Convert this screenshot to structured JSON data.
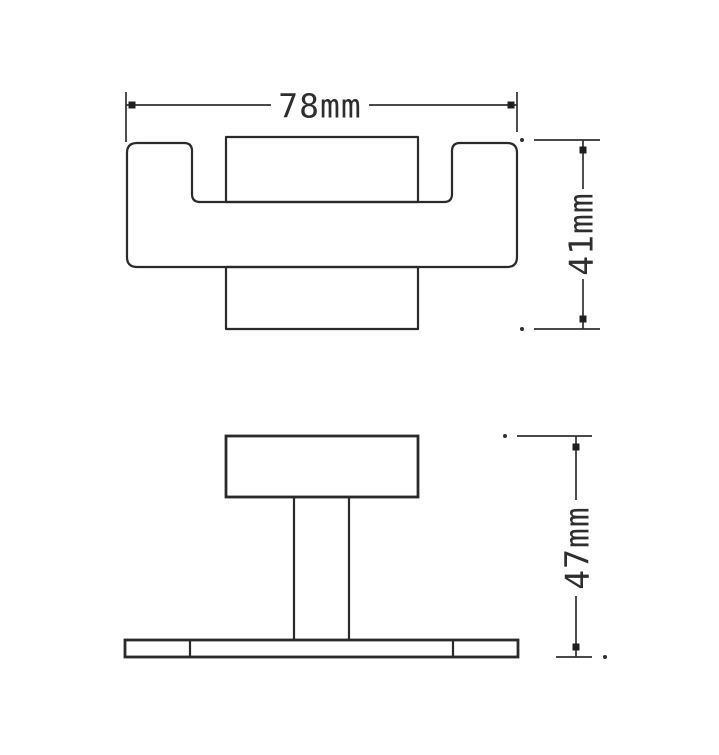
{
  "drawing": {
    "kind": "orthographic technical drawing",
    "subject": "wall hook / bathroom hook hardware",
    "background_color": "#ffffff",
    "line_color": "#2a2a2a",
    "views": {
      "top": {
        "name": "top-view",
        "dimensions": {
          "width": {
            "label": "78mm",
            "value": 78,
            "unit": "mm",
            "orientation": "horizontal"
          },
          "depth": {
            "label": "41mm",
            "value": 41,
            "unit": "mm",
            "orientation": "vertical"
          }
        }
      },
      "front": {
        "name": "front-view",
        "dimensions": {
          "height": {
            "label": "47mm",
            "value": 47,
            "unit": "mm",
            "orientation": "vertical"
          }
        }
      }
    }
  }
}
